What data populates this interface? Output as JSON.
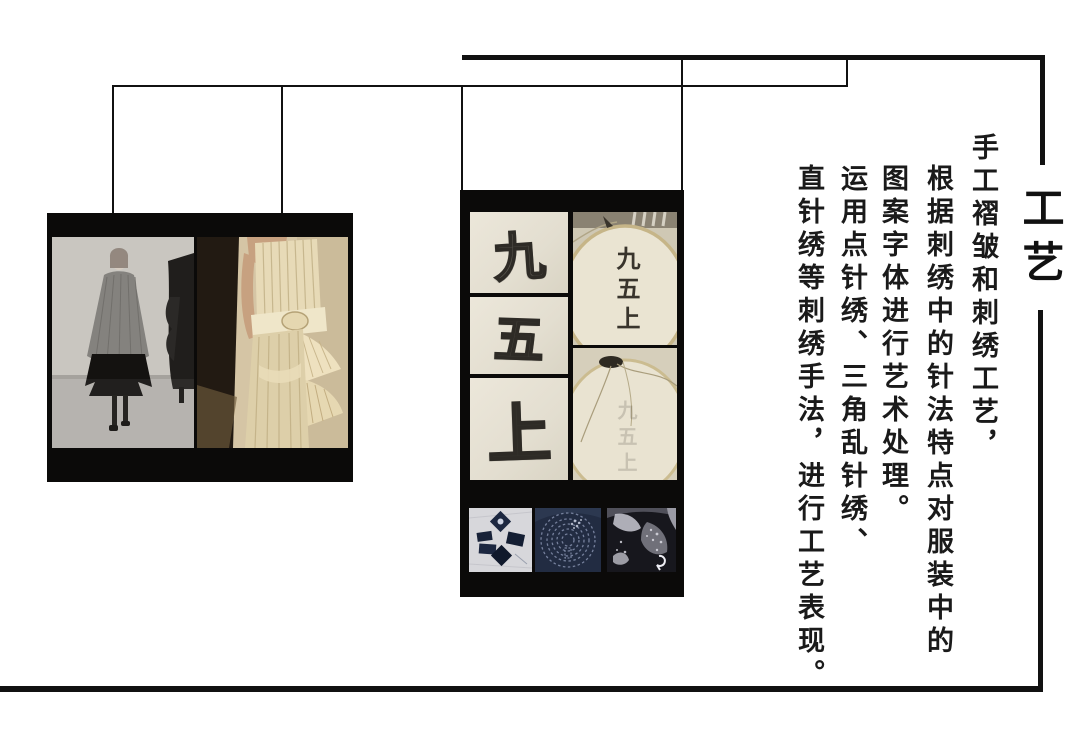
{
  "slide": {
    "background": "#ffffff",
    "line_color": "#111111"
  },
  "header": {
    "section_title": "工艺"
  },
  "description": {
    "columns": [
      "手工褶皱和刺绣工艺，",
      "根据刺绣中的针法特点对服装中的",
      "图案字体进行艺术处理。",
      "运用点针绣、三角乱针绣、",
      "直针绣等刺绣手法，进行工艺表现。"
    ]
  },
  "inspiration_board": {
    "photos": [
      {
        "name": "grey-pleated-runway-look"
      },
      {
        "name": "cream-pleated-dress-back"
      }
    ]
  },
  "embroidery_board": {
    "stitch_sketch_characters": [
      "九",
      "五",
      "上"
    ],
    "hoop_characters": "九五上",
    "swatches": [
      {
        "name": "indigo-diamond-stitch"
      },
      {
        "name": "indigo-spiral-stitch"
      },
      {
        "name": "dark-speckle-stitch"
      }
    ]
  },
  "colors": {
    "panel_black": "#0b0a09",
    "sketch_paper": "#e8e3d6",
    "hoop_fabric": "#e9e3d1",
    "indigo": "#20293e",
    "ink": "#2e2b26"
  }
}
